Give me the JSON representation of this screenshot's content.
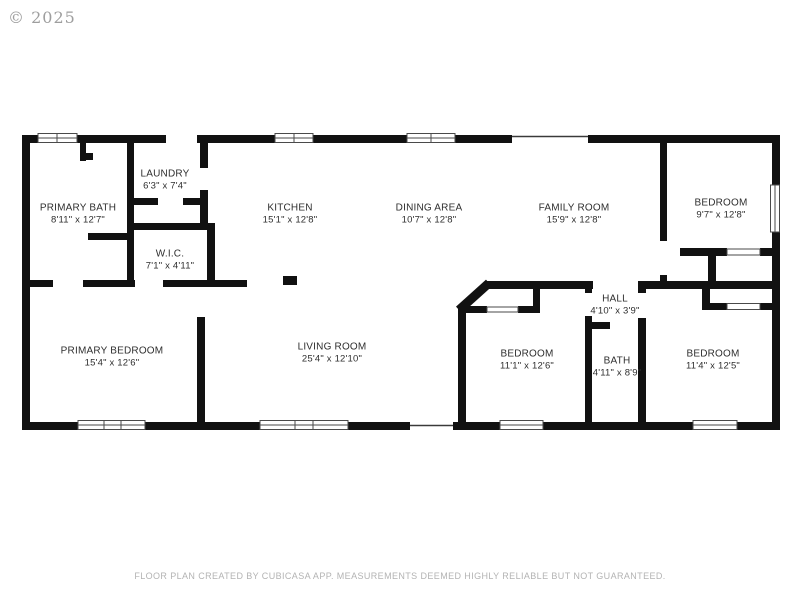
{
  "watermark": "© 2025",
  "footer": "FLOOR PLAN CREATED BY CUBICASA APP. MEASUREMENTS DEEMED HIGHLY RELIABLE BUT NOT GUARANTEED.",
  "colors": {
    "wall": "#111111",
    "text": "#2e2e2e",
    "muted": "#b3b3b3",
    "window_outline": "#4a4a4a"
  },
  "rooms": [
    {
      "name": "PRIMARY BATH",
      "dims": "8'11\" x 12'7\""
    },
    {
      "name": "LAUNDRY",
      "dims": "6'3\" x 7'4\""
    },
    {
      "name": "W.I.C.",
      "dims": "7'1\" x 4'11\""
    },
    {
      "name": "KITCHEN",
      "dims": "15'1\" x 12'8\""
    },
    {
      "name": "DINING AREA",
      "dims": "10'7\" x 12'8\""
    },
    {
      "name": "FAMILY ROOM",
      "dims": "15'9\" x 12'8\""
    },
    {
      "name": "BEDROOM",
      "dims": "9'7\" x 12'8\""
    },
    {
      "name": "PRIMARY BEDROOM",
      "dims": "15'4\" x 12'6\""
    },
    {
      "name": "LIVING ROOM",
      "dims": "25'4\" x 12'10\""
    },
    {
      "name": "BEDROOM",
      "dims": "11'1\" x 12'6\""
    },
    {
      "name": "HALL",
      "dims": "4'10\" x 3'9\""
    },
    {
      "name": "BATH",
      "dims": "4'11\" x 8'9\""
    },
    {
      "name": "BEDROOM",
      "dims": "11'4\" x 12'5\""
    }
  ]
}
